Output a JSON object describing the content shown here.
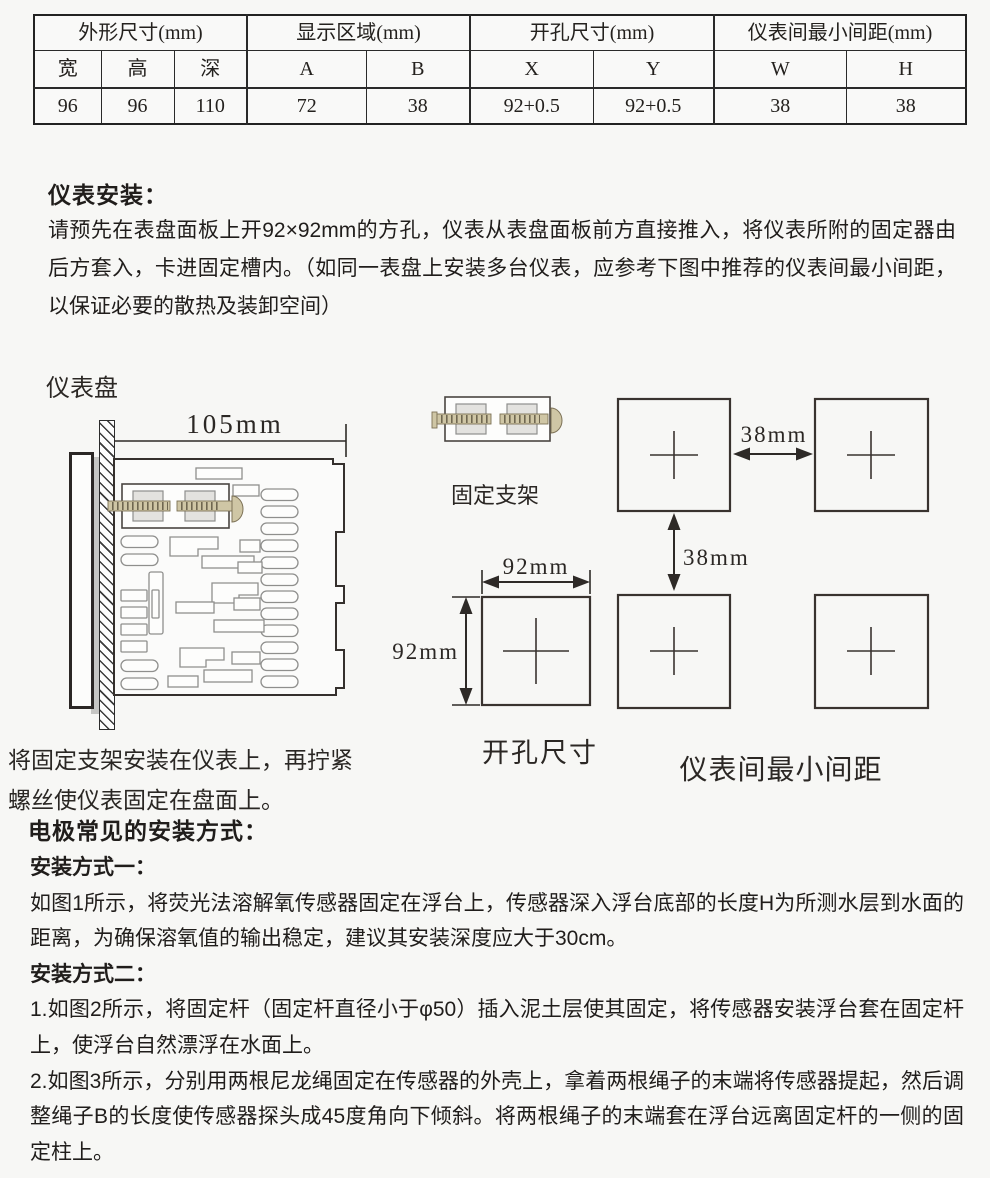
{
  "table": {
    "groups": [
      {
        "label": "外形尺寸(mm)"
      },
      {
        "label": "显示区域(mm)"
      },
      {
        "label": "开孔尺寸(mm)"
      },
      {
        "label": "仪表间最小间距(mm)"
      }
    ],
    "columns": [
      "宽",
      "高",
      "深",
      "A",
      "B",
      "X",
      "Y",
      "W",
      "H"
    ],
    "values": [
      "96",
      "96",
      "110",
      "72",
      "38",
      "92+0.5",
      "92+0.5",
      "38",
      "38"
    ]
  },
  "install": {
    "heading": "仪表安装：",
    "body": "请预先在表盘面板上开92×92mm的方孔，仪表从表盘面板前方直接推入，将仪表所附的固定器由后方套入，卡进固定槽内。（如同一表盘上安装多台仪表，应参考下图中推荐的仪表间最小间距，以保证必要的散热及装卸空间）"
  },
  "diagram": {
    "panel_label": "仪表盘",
    "depth_dim": "105mm",
    "bracket_label": "固定支架",
    "cutout_w_dim": "92mm",
    "cutout_h_dim": "92mm",
    "gap_h_dim": "38mm",
    "gap_v_dim": "38mm",
    "cutout_label": "开孔尺寸",
    "spacing_label": "仪表间最小间距",
    "caption": "将固定支架安装在仪表上，再拧紧螺丝使仪表固定在盘面上。"
  },
  "electrode": {
    "heading": "电极常见的安装方式：",
    "method1_label": "安装方式一：",
    "method1_body": "如图1所示，将荧光法溶解氧传感器固定在浮台上，传感器深入浮台底部的长度H为所测水层到水面的距离，为确保溶氧值的输出稳定，建议其安装深度应大于30cm。",
    "method2_label": "安装方式二：",
    "method2_item1": "1.如图2所示，将固定杆（固定杆直径小于φ50）插入泥土层使其固定，将传感器安装浮台套在固定杆上，使浮台自然漂浮在水面上。",
    "method2_item2": "2.如图3所示，分别用两根尼龙绳固定在传感器的外壳上，拿着两根绳子的末端将传感器提起，然后调整绳子B的长度使传感器探头成45度角向下倾斜。将两根绳子的末端套在浮台远离固定杆的一侧的固定柱上。"
  }
}
